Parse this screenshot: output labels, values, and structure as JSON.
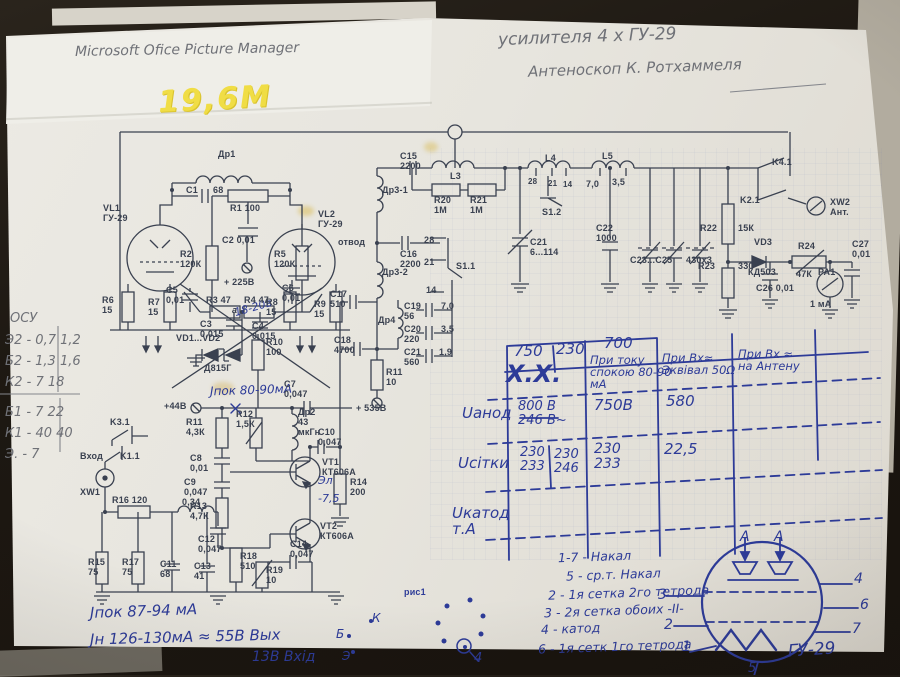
{
  "titles": {
    "app": "Microsoft Ofice Picture Manager",
    "schematic": "усилителя   4 х ГУ-29",
    "source": "Антеноскоп  К. Ротхаммеля",
    "band": "19,6М"
  },
  "margin": [
    "ОСУ",
    "Э2 - 0,7    1,2",
    "Б2 - 1,3    1,6",
    "К2 - 7     18",
    "Б1 - 7     22",
    "К1 - 40    40",
    "Э. - 7"
  ],
  "bottom_notes": [
    "Jпок 87-94 мА",
    "Jн  126-130мА ≈ 55В Вых",
    "13В Вхід"
  ],
  "pinout_letters": {
    "k": "К",
    "b": "Б",
    "e": "Э"
  },
  "fig": {
    "label": "рис1",
    "pin": "4"
  },
  "pinlist": [
    "1-7 - Накал",
    "5 - ср.т. Накал",
    "2 - 1я сетка 2го тетрода",
    "3 - 2я сетка обоих -II-",
    "4 - катод",
    "6 - 1я сетк 1го тетрода"
  ],
  "tube": {
    "a1": "А",
    "a2": "А",
    "name": "ГУ-29",
    "p1": "1",
    "p2": "2",
    "p3": "3",
    "p4": "4",
    "p5": "5",
    "p6": "6",
    "p7": "7"
  },
  "table": {
    "top": [
      "750",
      "230",
      "700"
    ],
    "cols": [
      "Х.Х.",
      "При току\nспокою 80-90\nмА",
      "При Вх≈\nЭквівал 50Ω",
      "При Вх ≈\nна Антену"
    ],
    "r1": {
      "label": "Uанод",
      "v1": "800 В\n246 В~",
      "v2": "750В",
      "v3": "580"
    },
    "r2": {
      "label": "Uсітки",
      "v1": "230\n233",
      "v2": "230\n246",
      "v3": "230\n233",
      "v4": "22,5"
    },
    "r3": {
      "label": "Uкатод\nт.А"
    }
  },
  "hand": {
    "j8090": "Jпок 80-90мА",
    "v1820": "18-20в",
    "e1": "Эл",
    "m75": "-7,5"
  },
  "parts": {
    "dr1": "Др1",
    "c1": "C1",
    "c1v": "68",
    "r1": "R1 100",
    "vl1": "VL1\nГУ-29",
    "vl2": "VL2\nГУ-29",
    "r2": "R2\n120К",
    "r5": "R5\n120К",
    "c2": "C2  0,01",
    "r3": "R3 47",
    "r4": "R4 47",
    "c3": "C3\n0,015",
    "c4": "C4\n0,015",
    "v225": "+ 225В",
    "c5": "C5\n0,01",
    "c6": "C6\n0,01",
    "r6": "R6\n15",
    "r7": "R7\n15",
    "r8": "R8\n15",
    "r9": "R9\n15",
    "pt_a": "а",
    "vd12": "VD1...VD2",
    "d815": "Д815Г",
    "r10": "R10\n100",
    "c17": "C17\n510",
    "c18": "C18\n4700",
    "dr4": "Др4",
    "c19": "C19\n56",
    "c19v": "7,0",
    "c20": "C20\n220",
    "c20v": "3,5",
    "c21b": "C21\n560",
    "c21bv": "1,9",
    "n14": "14",
    "r11b": "R11\n10",
    "v535": "+ 535В",
    "c15": "C15\n2200",
    "l3": "L3",
    "dr31": "Др3-1",
    "otvod": "отвод",
    "c16": "C16\n2200",
    "dr32": "Др3-2",
    "r20": "R20\n1М",
    "r21": "R21\n1М",
    "n28": "28",
    "n21": "21",
    "s11": "S1.1",
    "l4": "L4",
    "l5": "L5",
    "t28": "28",
    "t21": "21",
    "t14": "14",
    "t70": "7,0",
    "t35": "3,5",
    "s12": "S1.2",
    "c21": "C21\n6...114",
    "c22": "C22\n1000",
    "c2325": "C23...C25",
    "c2325v": "430х3",
    "r22": "R22",
    "r22v": "15К",
    "vd3": "VD3",
    "vd3v": "КД503",
    "r23": "R23",
    "r23v": "330",
    "r24": "R24",
    "r24v": "47К",
    "c26": "C26 0,01",
    "pa1": "PA1",
    "pa1v": "1 мА",
    "c27": "C27\n0,01",
    "k41": "K4.1",
    "k21": "K2.1",
    "xw2": "XW2\nАнт.",
    "k31": "K3.1",
    "k11": "K1.1",
    "vhod": "Вход",
    "xw1": "XW1",
    "r16": "R16  120",
    "l034": "0,34",
    "v44": "+44В",
    "r11a": "R11\n4,3К",
    "r12": "R12\n1,5К",
    "dr2": "Др2\n43\nмкГн",
    "c10": "C10\n0,047",
    "c8": "C8\n0,01",
    "c9": "C9\n0,047",
    "vt1": "VT1\nКТ606А",
    "vt2": "VT2\nКТ606А",
    "r13": "R13\n4,7К",
    "r14": "R14\n200",
    "c7": "C7\n0,047",
    "c12": "C12\n0,047",
    "r15": "R15\n75",
    "r17": "R17\n75",
    "c11": "C11\n68",
    "c13": "C13\n41",
    "r18": "R18\n510",
    "r19": "R19\n10",
    "c14": "C14\n0,047",
    "ris1": "рис1"
  }
}
